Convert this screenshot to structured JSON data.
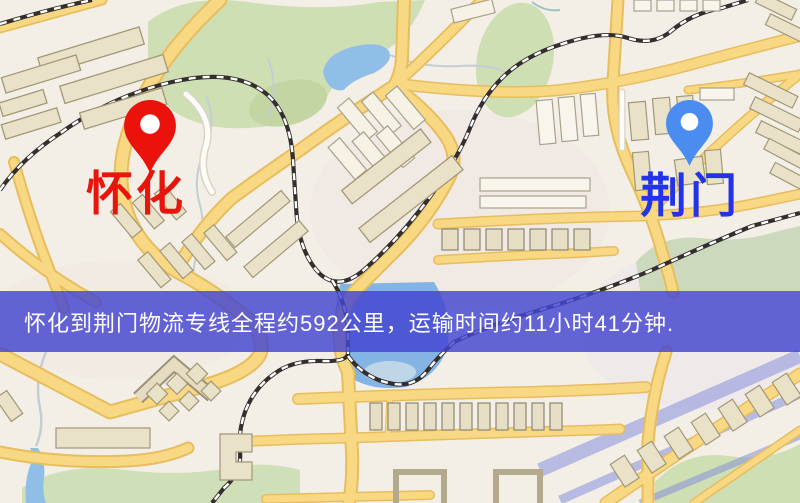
{
  "banner": {
    "text": "怀化到荆门物流专线全程约592公里，运输时间约11小时41分钟.",
    "bg_color": "#4646d0",
    "text_color": "#ffffff"
  },
  "route": {
    "origin": {
      "label": "怀化",
      "label_color": "#e8150d",
      "pin_color": "#ea120b",
      "pin_icon": "red-pin-icon"
    },
    "destination": {
      "label": "荆门",
      "label_color": "#2433e8",
      "pin_color": "#4a8cf0",
      "pin_icon": "blue-pin-icon"
    },
    "distance_text": "约592公里",
    "duration_text": "约11小时41分钟"
  },
  "map": {
    "palette": {
      "background": "#f3efe6",
      "road_fill": "#f8d883",
      "road_casing": "#e7bd5e",
      "water": "#8fbfe6",
      "park": "#cfdfb4",
      "building": "#e9e1c8",
      "railway": "#332f2e",
      "canal_overlay": "#7f88dd"
    }
  }
}
